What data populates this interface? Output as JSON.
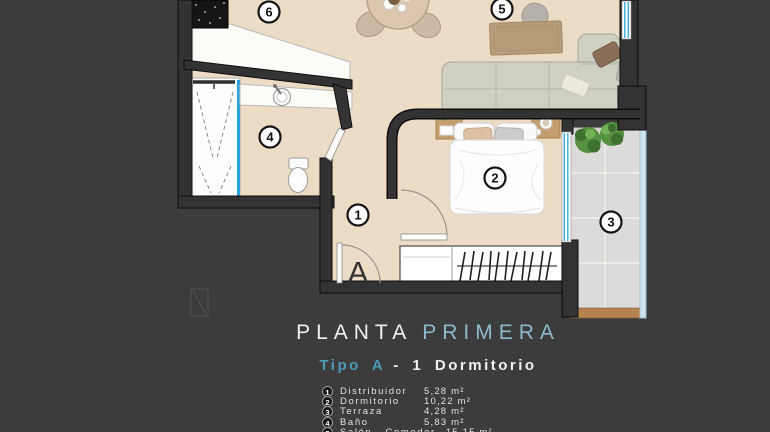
{
  "title": {
    "part1": "PLANTA",
    "part2": "PRIMERA"
  },
  "subtitle": {
    "part1": "Tipo A",
    "part2": "- 1 Dormitorio"
  },
  "legend": {
    "rows": [
      {
        "number": "1",
        "name": "Distribuidor",
        "area": "5,28 m²"
      },
      {
        "number": "2",
        "name": "Dormitorio",
        "area": "10,22 m²"
      },
      {
        "number": "3",
        "name": "Terraza",
        "area": "4,28 m²"
      },
      {
        "number": "4",
        "name": "Baño",
        "area": "5,83 m²"
      },
      {
        "number": "5",
        "name": "Salón - Comedor",
        "area": "15,15 m²"
      }
    ]
  },
  "plan": {
    "entrance_label": "A",
    "badges": [
      "1",
      "2",
      "3",
      "4",
      "5",
      "6"
    ],
    "colors": {
      "background": "#3c3c3c",
      "floor": "#ecdcc6",
      "wall": "#333333",
      "terrace_tile": "#dbdbd9",
      "terrace_wood": "#b5834f",
      "glass_blue": "#29a3dc",
      "title_accent": "#8fb9cb",
      "subtitle_accent": "#4c9cb8"
    }
  }
}
